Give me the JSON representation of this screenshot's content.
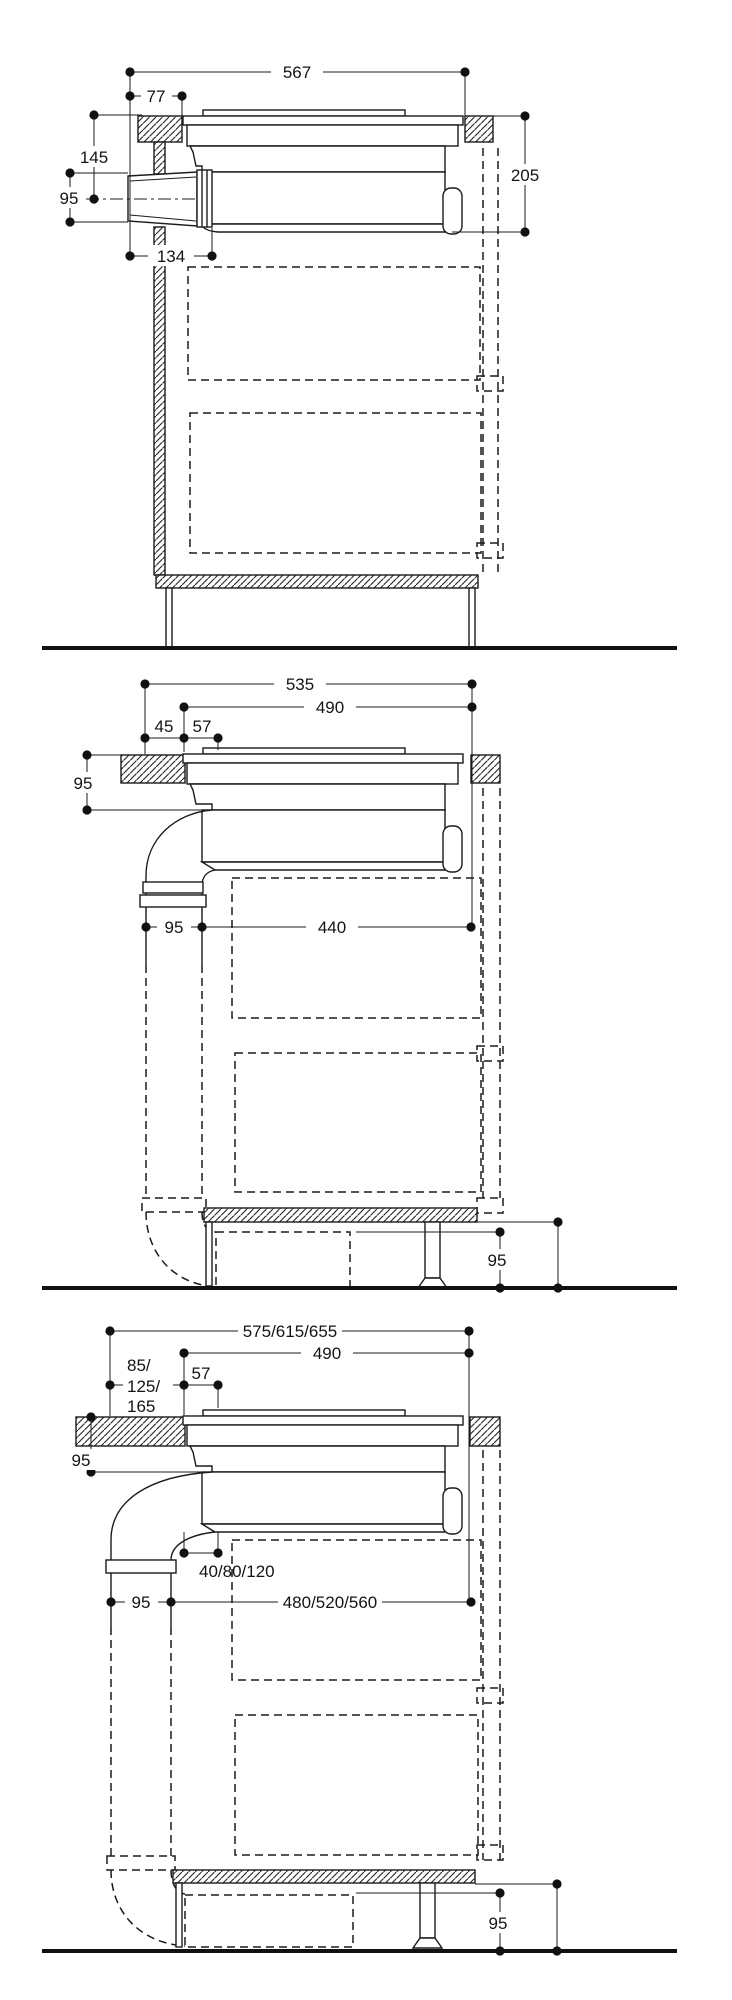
{
  "panels": {
    "p1": {
      "top_width": "567",
      "rear_offset": "77",
      "counter_to_duct_center": "145",
      "duct_height": "95",
      "overall_depth": "205",
      "duct_length": "134"
    },
    "p2": {
      "top_width": "535",
      "cutout_width": "490",
      "rear_gap": "45",
      "front_gap": "57",
      "counter_to_duct_top": "95",
      "pipe_width": "95",
      "floor_run": "440",
      "plinth_height": "95"
    },
    "p3": {
      "top_width": "575/615/655",
      "cutout_width": "490",
      "overhang_line1": "85/",
      "overhang_line2": "125/",
      "overhang_line3": "165",
      "front_gap": "57",
      "counter_to_duct_top": "95",
      "duct_offset": "40/80/120",
      "pipe_width": "95",
      "floor_run": "480/520/560",
      "plinth_height": "95"
    }
  }
}
